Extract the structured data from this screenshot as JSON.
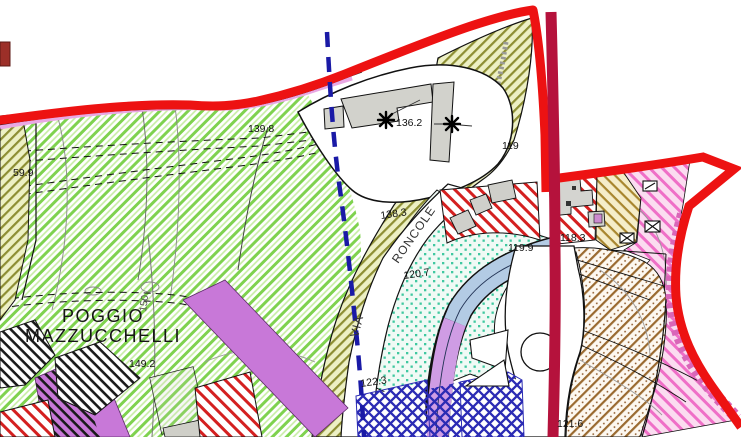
{
  "map": {
    "place_labels": {
      "poggio_line1": "POGGIO",
      "poggio_line2": "MAZZUCCHELLI"
    },
    "roads": {
      "via": "VIA",
      "roncole": "RONCOLE"
    },
    "elevations": {
      "e59_9": "59.9",
      "e139_8": "139.8",
      "e136_2": "136.2",
      "e138_3": "138.3",
      "e119": "119",
      "e118_3": "118.3",
      "e119_9": "119.9",
      "e120_7": "120.7",
      "e122_3": "122.3",
      "e149_2": "149.2",
      "e121_6": "121.6",
      "contour_150": "150"
    },
    "icons": {
      "tree_symbol": "8-spoke-asterisk",
      "annex_x_symbol": "boxed-x",
      "annex_slash_symbol": "boxed-slash"
    },
    "colors": {
      "boundary_red": "#ed1212",
      "road_crimson": "#b5123c",
      "pink_stripe": "#e9a8e4",
      "green_hatch": "#7fd24f",
      "olive_hatch": "#8d8e33",
      "cyan_dot": "#3fc8a0",
      "blue_crosshatch": "#2b2bb4",
      "purple_fill": "#c878d8",
      "pink_hatch": "#ef6fc7",
      "brown_hatch": "#9a6a30",
      "red_hatch": "#d42020",
      "blue_dashed_boundary": "#1a1aa6"
    }
  }
}
